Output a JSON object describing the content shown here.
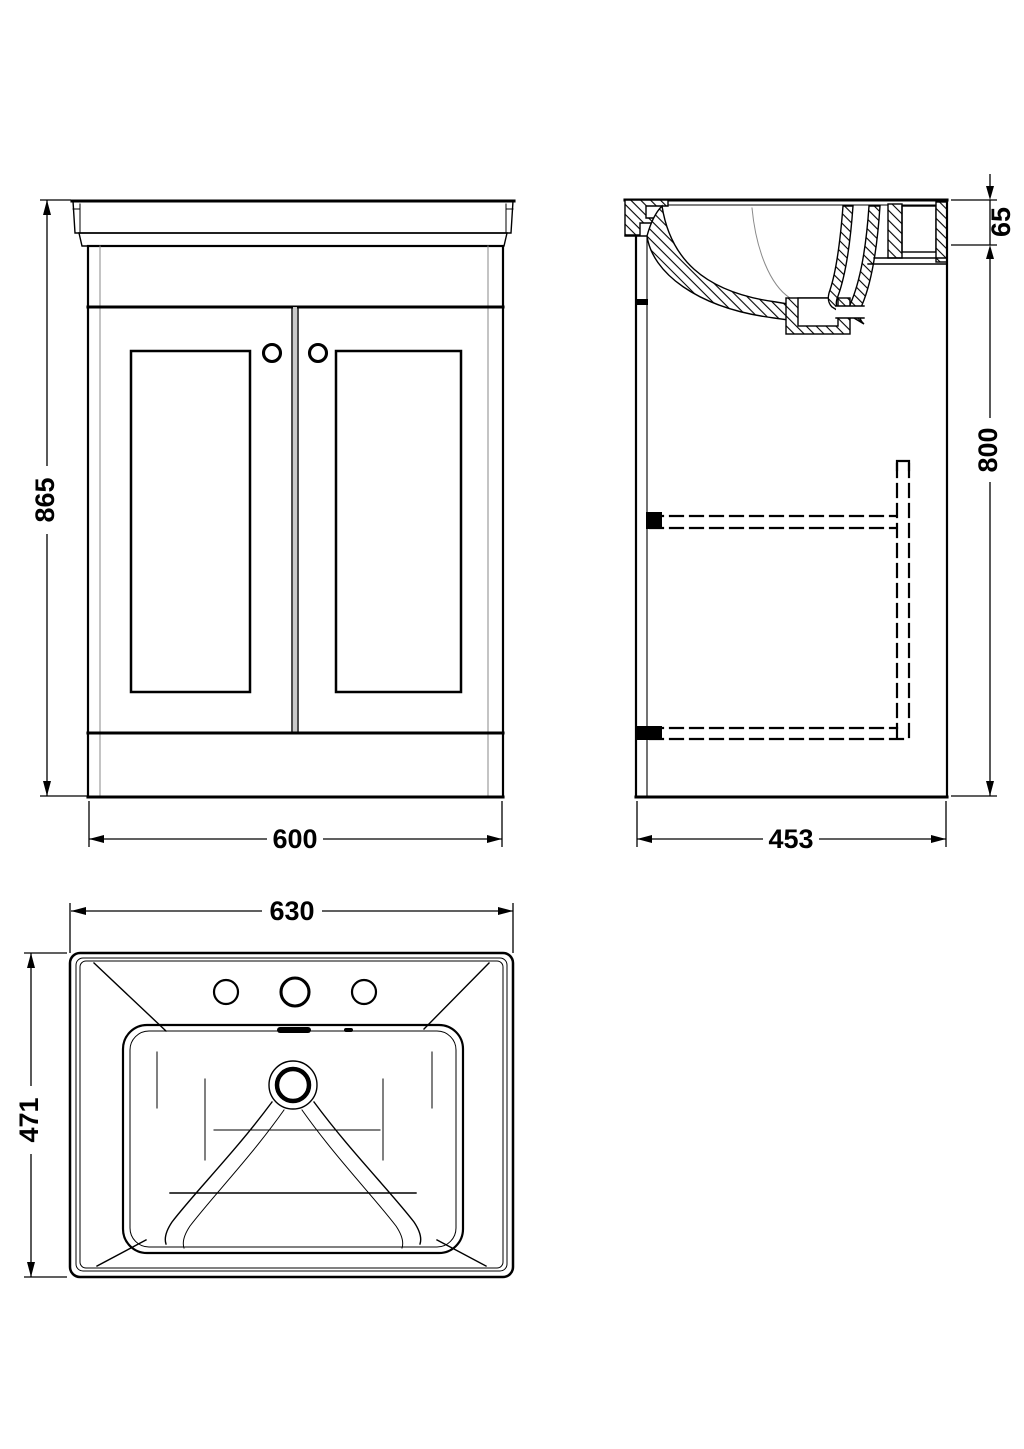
{
  "dimensions": {
    "front_height": "865",
    "front_width": "600",
    "side_basin_height": "65",
    "side_cabinet_height": "800",
    "side_depth": "453",
    "basin_width": "630",
    "basin_depth": "471"
  },
  "colors": {
    "line": "#000000",
    "background": "#ffffff",
    "light_line": "#8a8a8a"
  }
}
